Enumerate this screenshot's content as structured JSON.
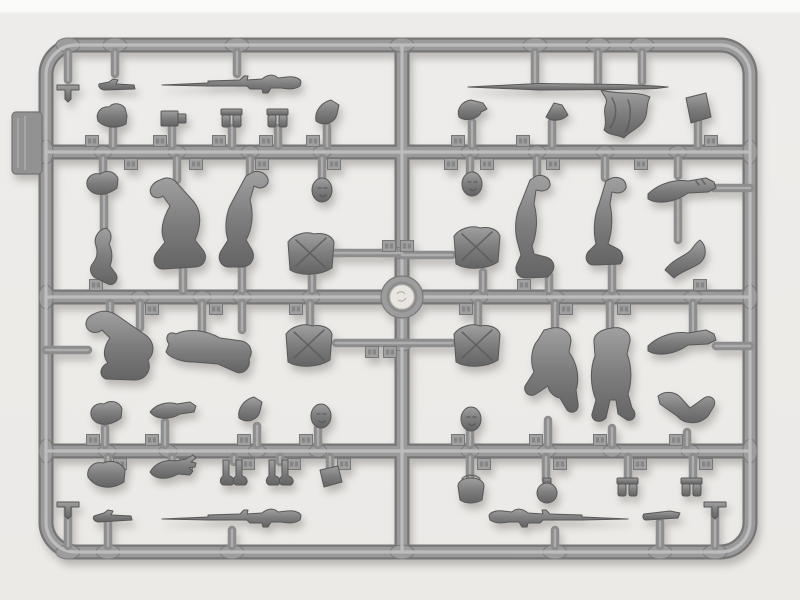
{
  "scene": {
    "description": "Photograph of a gray plastic model-kit sprue with unassembled miniature soldier figure parts on a white background",
    "palette": {
      "background": "#edecea",
      "top_strip": "#fbfbfa",
      "sprue_base": "#9a9a9a",
      "sprue_shadow": "#767676",
      "sprue_highlight": "#c3c3c3",
      "part_base": "#7d7d7d",
      "part_dark": "#5f5f5f",
      "hub_center": "#e9e6e1",
      "gate_tab": "#929292"
    }
  },
  "structure": {
    "frame": "rounded rectangular sprue frame",
    "runner_top": "upper horizontal runner",
    "runner_middle": "middle horizontal runner",
    "runner_bottom": "lower horizontal runner",
    "runner_center": "central vertical runner",
    "hub": "central circular hub",
    "mold_mark": "round mold mark in hub",
    "gate_tab": "flat gate tab on left frame edge",
    "pads": "oval junction pads on runners",
    "tabs": "small embossed part-number tabs",
    "stubs": "short attachment stubs holding parts"
  },
  "parts": {
    "tpin_top_left": "small T-shaped pin",
    "rod_top_left": "small rod tool",
    "rifle_top_left": "rifle with fixed bayonet pointing left",
    "lance": "long thin lance blade",
    "flag": "draped cloth flag",
    "case_right": "flat rectangular case",
    "boot_upper_a": "folded boot part",
    "ammo_box": "small ammunition box",
    "pouch_pair_a": "paired ammo pouches",
    "pouch_pair_b": "paired ammo pouches",
    "side_cap_a": "side cap",
    "visor_cap": "visor cap",
    "peak_hat": "small peaked hat",
    "rolled_cap_a": "rolled forage cap",
    "bent_arm_a": "bent arm",
    "legs_zigzag": "legs bent sharply at the knee",
    "legs_kneeling": "kneeling legs",
    "head_a": "bare head",
    "head_b": "bare head",
    "legs_boot_up_a": "inverted legs with raised boot",
    "legs_boot_up_b": "inverted legs with raised boot",
    "arm_pair_a": "pair of joined arms",
    "bent_arm_b": "bent arm with hand",
    "torso_a": "torso with crossed equipment straps",
    "torso_b": "torso with crossed equipment straps",
    "torso_c": "torso with crossed equipment straps",
    "torso_d": "torso with crossed equipment straps",
    "seated_legs_a": "seated bent legs",
    "seated_legs_b": "seated legs with boots raised",
    "legs_bent_knee": "legs with one knee bent",
    "legs_standing": "standing legs with boots",
    "arm_pair_b": "pair of joined arms",
    "bent_arm_c": "bent arm, elbow out",
    "rolled_cap_b": "rolled forage cap",
    "arm_extended": "extended straight arm",
    "side_cap_b": "side cap",
    "head_c": "bare head",
    "head_d": "bare head",
    "tall_boot": "tall boot",
    "arm_open_hand": "arm with open hand",
    "boots_pair_a": "pair of small boots",
    "boots_pair_b": "pair of small boots",
    "pouch_small": "small flat pouch",
    "mess_tin": "mess tin with handle",
    "canteen": "round canteen",
    "pouch_pair_c": "paired ammo pouches",
    "pouch_pair_d": "paired ammo pouches",
    "rifle_bottom_left": "rifle with fixed bayonet pointing left",
    "rod_bottom_left": "cleaning rod",
    "tpin_bottom_left": "small T-shaped pin",
    "rifle_bottom_right": "rifle with fixed bayonet pointing right",
    "rod_bottom_right": "cleaning rod",
    "tpin_bottom_right": "small T-shaped pin"
  }
}
